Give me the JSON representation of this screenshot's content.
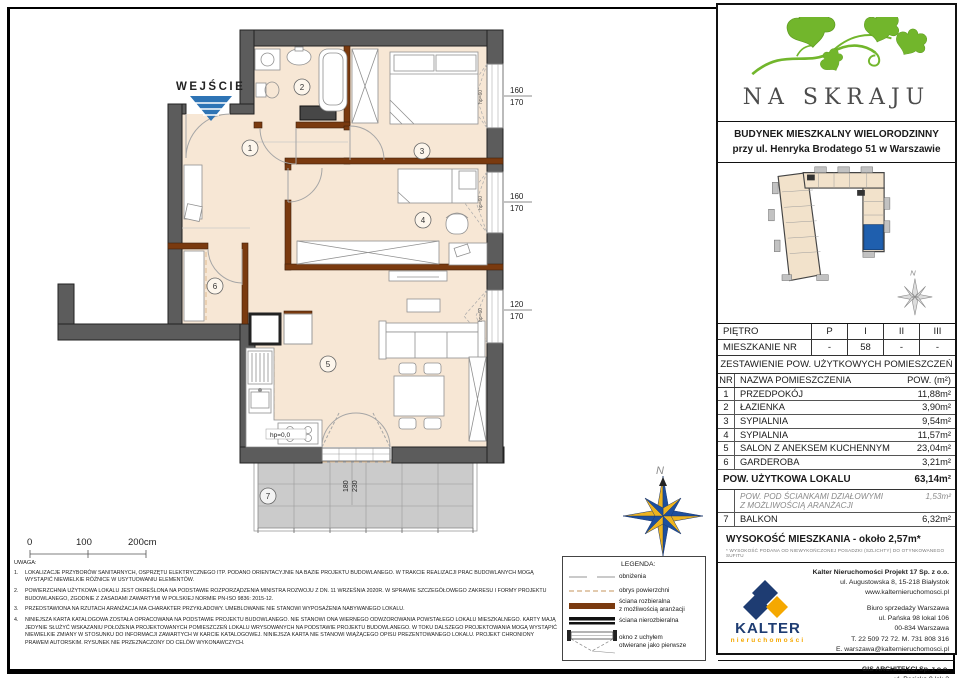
{
  "plan": {
    "entrance": "WEJŚCIE",
    "north": "N",
    "rooms": {
      "r1": "1",
      "r2": "2",
      "r3": "3",
      "r4": "4",
      "r5": "5",
      "r6": "6",
      "r7": "7"
    },
    "windows": [
      {
        "w": "160",
        "h": "170",
        "sill": "hp=60"
      },
      {
        "w": "160",
        "h": "170",
        "sill": "hp=60"
      },
      {
        "w": "120",
        "h": "170",
        "sill": "hp=60"
      }
    ],
    "balcony_door": {
      "w": "180",
      "h": "230",
      "level": "hp=0,0"
    }
  },
  "scale_bar": {
    "t0": "0",
    "t1": "100",
    "t2": "200cm"
  },
  "notes": {
    "title": "UWAGA:",
    "items": [
      "LOKALIZACJE PRZYBORÓW SANITARNYCH, OSPRZĘTU ELEKTRYCZNEGO ITP. PODANO ORIENTACYJNIE NA BAZIE PROJEKTU BUDOWLANEGO. W TRAKCIE REALIZACJI PRAC BUDOWLANYCH MOGĄ WYSTĄPIĆ NIEWIELKIE RÓŻNICE W USYTUOWANIU ELEMENTÓW.",
      "POWIERZCHNIA UŻYTKOWA LOKALU JEST OKREŚLONA NA PODSTAWIE ROZPORZĄDZENIA MINISTRA ROZWOJU Z DN. 11 WRZEŚNIA 2020R. W SPRAWIE SZCZEGÓŁOWEGO ZAKRESU I FORMY PROJEKTU BUDOWLANEGO, ZGODNIE Z ZASADAMI ZAWARTYMI W POLSKIEJ NORMIE PN-ISO 9836: 2015-12.",
      "PRZEDSTAWIONA NA RZUTACH ARANŻACJA MA CHARAKTER PRZYKŁADOWY. UMEBLOWANIE NIE STANOWI WYPOSAŻENIA NABYWANEGO LOKALU.",
      "NINIEJSZA KARTA KATALOGOWA ZOSTAŁA OPRACOWANA NA PODSTAWIE PROJEKTU BUDOWLANEGO. NIE STANOWI ONA WIERNEGO ODWZOROWANIA POWSTAŁEGO LOKALU MIESZKALNEGO. KARTY MAJĄ JEDYNIE SŁUŻYĆ WSKAZANIU POŁOŻENIA PROJEKTOWANYCH POMIESZCZEŃ LOKALU WRYSOWANYCH NA PODSTAWIE PROJEKTU BUDOWLANEGO. W TOKU DALSZEGO PROJEKTOWANIA MOGĄ WYSTĄPIĆ NIEWIELKIE ZMIANY W STOSUNKU DO INFORMACJI ZAWARTYCH W KARCIE KATALOGOWEJ. NINIEJSZA KARTA NIE STANOWI WIĄŻĄCEGO OPISU PREZENTOWANEGO LOKALU. PROJEKT CHRONIONY PRAWEM AUTORSKIM. RYSUNEK NIE PRZEZNACZONY DO CELÓW WYKONAWCZYCH."
    ]
  },
  "legend": {
    "title": "LEGENDA:",
    "items": [
      "obniżenia",
      "obrys powierzchni",
      "ściana rozbieralna\nz możliwością aranżacji",
      "ściana nierozbieralna",
      "okno z uchyłem\notwierane jako pierwsze"
    ]
  },
  "panel": {
    "brand": "NA SKRAJU",
    "building_line1": "BUDYNEK MIESZKALNY WIELORODZINNY",
    "building_line2": "przy ul. Henryka Brodatego 51 w Warszawie",
    "north": "N",
    "floor": {
      "label": "PIĘTRO",
      "values": [
        "P",
        "I",
        "II",
        "III"
      ]
    },
    "unit": {
      "label": "MIESZKANIE NR",
      "values": [
        "-",
        "58",
        "-",
        "-"
      ]
    },
    "areas_title": "ZESTAWIENIE POW. UŻYTKOWYCH POMIESZCZEŃ",
    "areas_head": {
      "nr": "NR",
      "name": "NAZWA POMIESZCZENIA",
      "area": "POW. (m²)"
    },
    "areas": [
      {
        "nr": "1",
        "name": "PRZEDPOKÓJ",
        "area": "11,88m²"
      },
      {
        "nr": "2",
        "name": "ŁAZIENKA",
        "area": "3,90m²"
      },
      {
        "nr": "3",
        "name": "SYPIALNIA",
        "area": "9,54m²"
      },
      {
        "nr": "4",
        "name": "SYPIALNIA",
        "area": "11,57m²"
      },
      {
        "nr": "5",
        "name": "SALON Z ANEKSEM KUCHENNYM",
        "area": "23,04m²"
      },
      {
        "nr": "6",
        "name": "GARDEROBA",
        "area": "3,21m²"
      }
    ],
    "total": {
      "label": "POW. UŻYTKOWA LOKALU",
      "area": "63,14m²"
    },
    "partitions": {
      "label": "POW. POD ŚCIANKAMI DZIAŁOWYMI\nZ MOŻLIWOŚCIĄ ARANŻACJI",
      "area": "1,53m²"
    },
    "balcony": {
      "nr": "7",
      "label": "BALKON",
      "area": "6,32m²"
    },
    "height": {
      "label": "WYSOKOŚĆ MIESZKANIA - około 2,57m*",
      "note": "* WYSOKOŚĆ PODANA OD NIEWYKOŃCZONEJ POSADZKI (SZLICHTY) DO OTYNKOWANEGO SUFITU"
    },
    "developer": {
      "brand": "KALTER",
      "brand_sub": "nieruchomości",
      "hq1": "Kalter Nieruchomości Projekt 17 Sp. z o.o.",
      "hq2": "ul. Augustowska 8, 15-218 Białystok",
      "hq3": "www.kalternieruchomosci.pl",
      "office1": "Biuro sprzedaży Warszawa",
      "office2": "ul. Pańska 98 lokal 106",
      "office3": "00-834 Warszawa",
      "office4": "T. 22 509 72 72. M. 731 808 316",
      "office5": "E. warszawa@kalternieruchomosci.pl",
      "arch1": "GIS ARCHITEKCI Sp. z o.o.",
      "arch2": "ul. Pęcicka 9 lok 2",
      "arch3": "01-688 Warszawa",
      "arch4": "www.gisarchitekci.pl"
    }
  },
  "colors": {
    "floor": "#f7e7d5",
    "wall": "#5c5c5c",
    "partition_brown": "#7a3a0f",
    "balcony_gray": "#cbcbcb",
    "entrance_blue": "#2e74b5",
    "compass_blue": "#1d4f9e",
    "compass_yellow": "#edb31f",
    "logo_green": "#72b62c",
    "kalter_blue": "#1e3c72",
    "kalter_yellow": "#f5a800",
    "highlight_unit": "#1f5fae"
  }
}
